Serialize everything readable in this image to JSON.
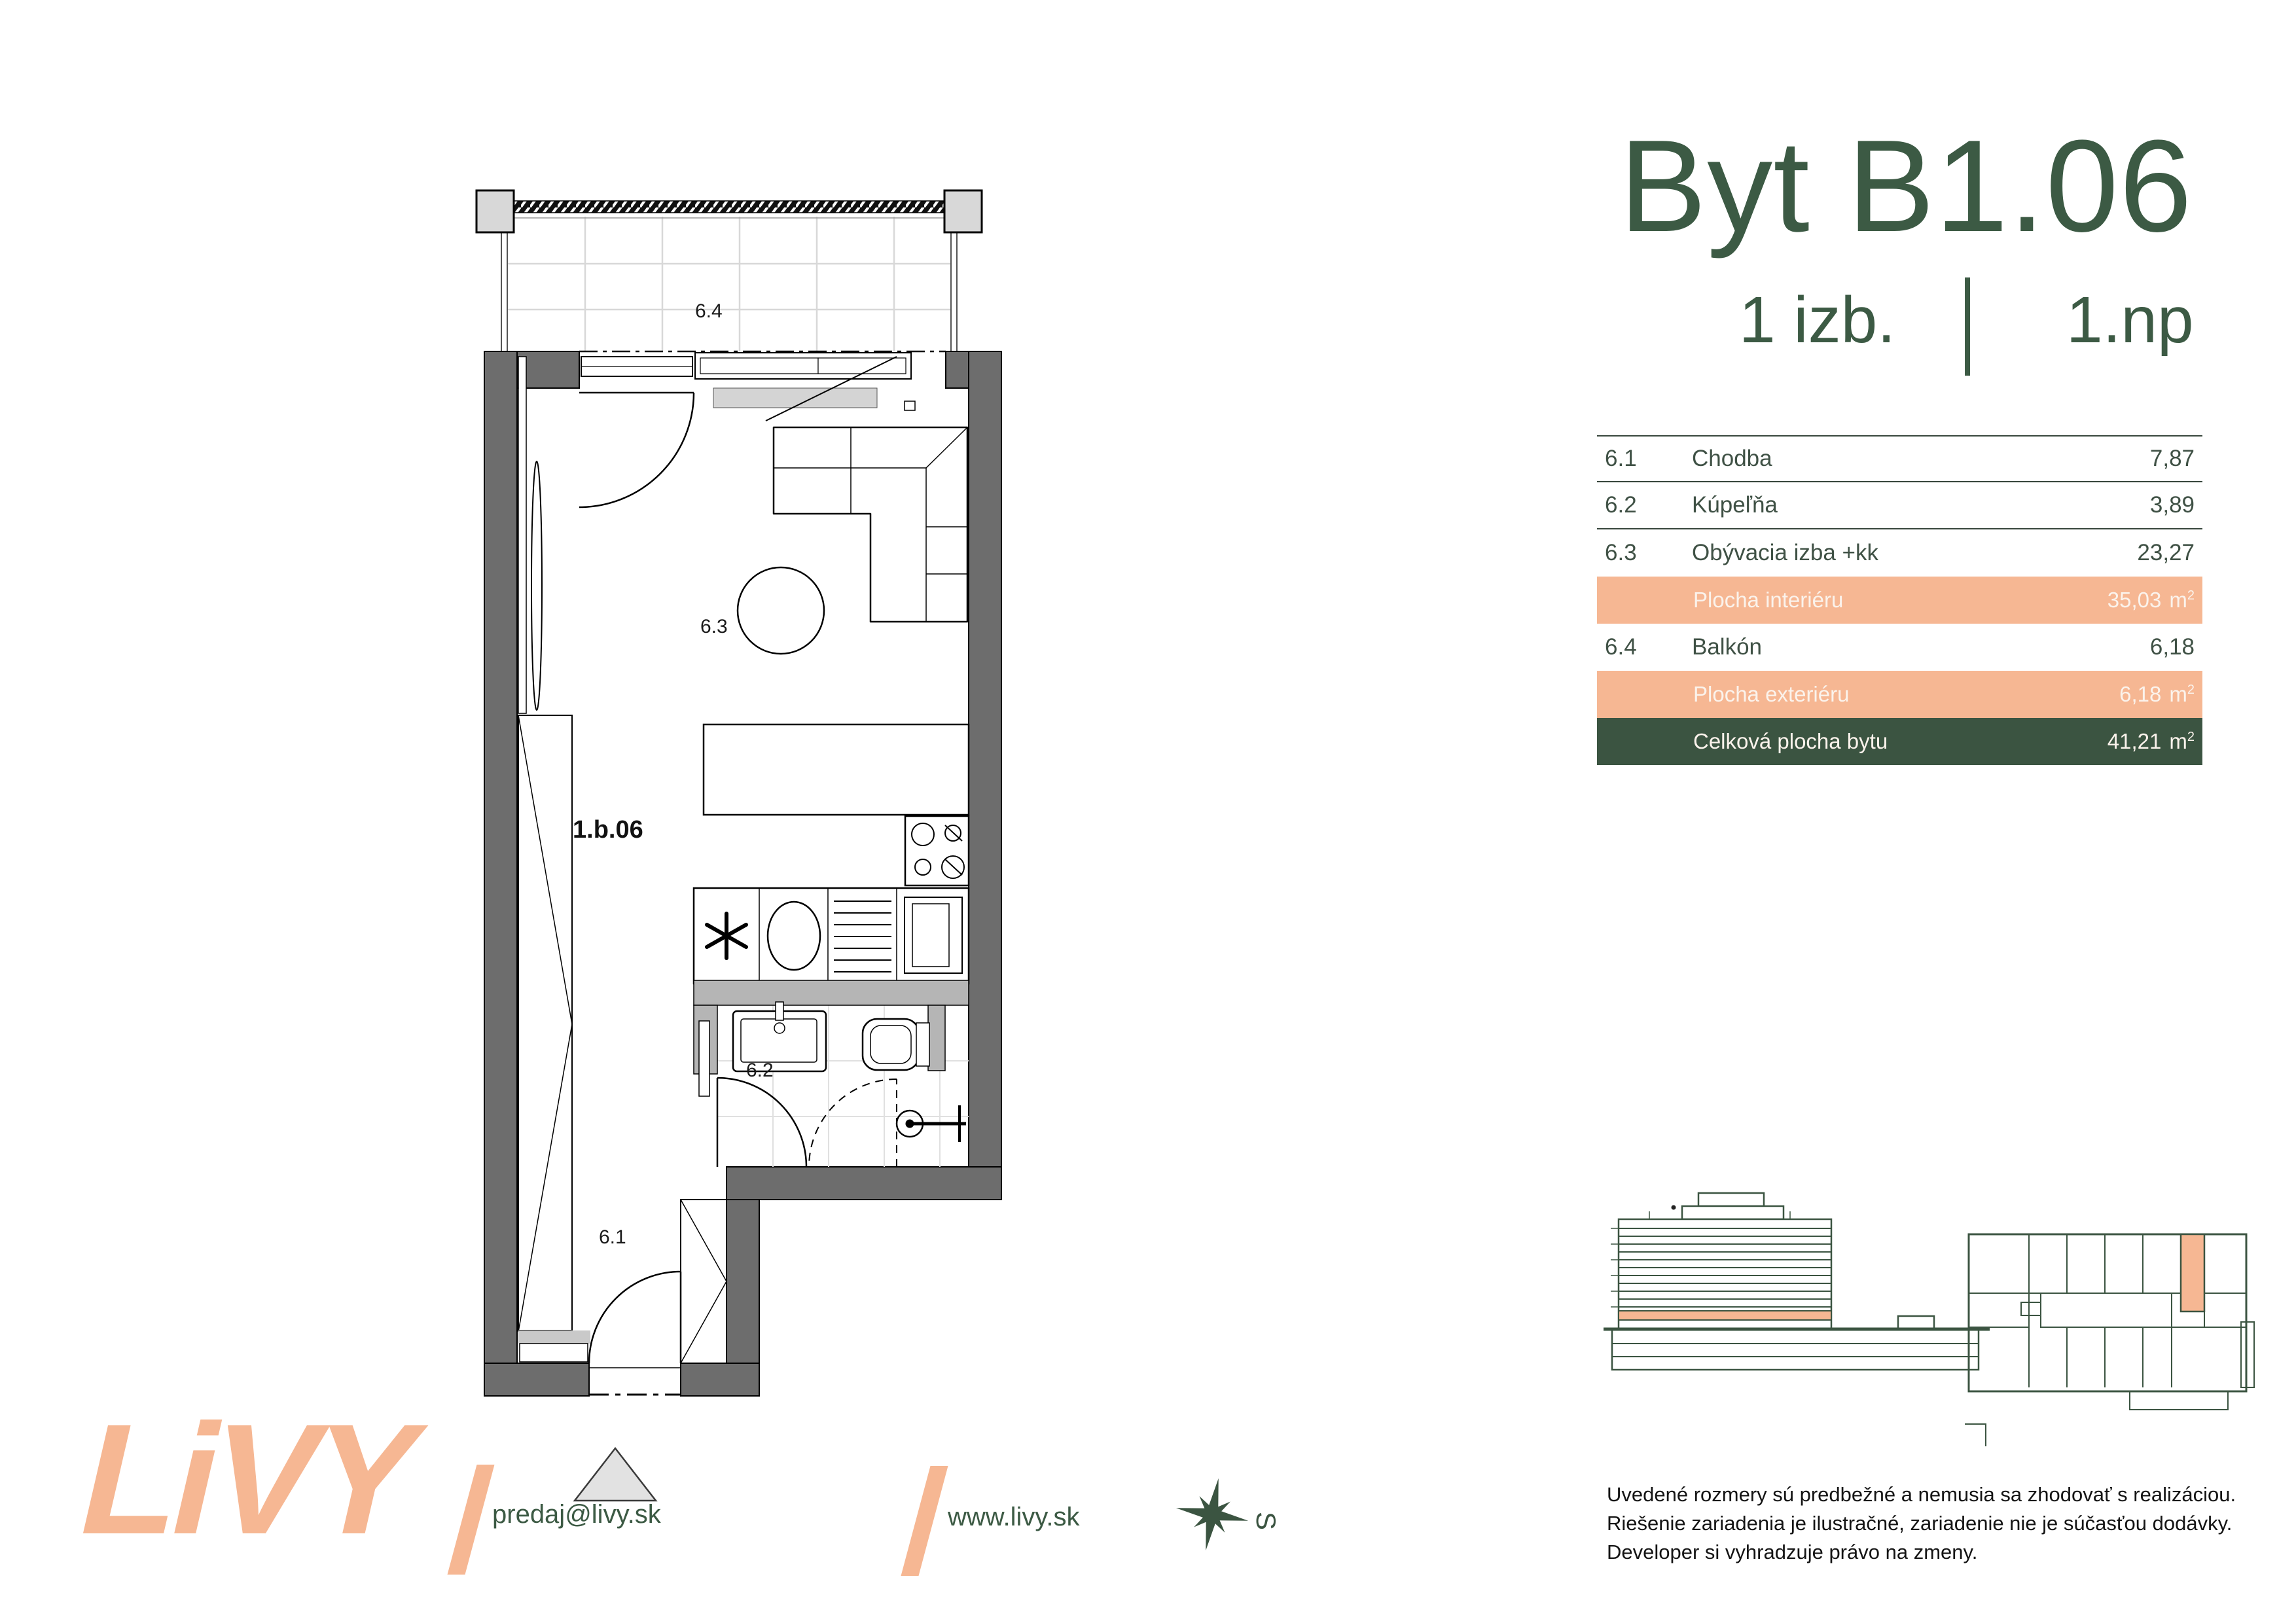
{
  "header": {
    "title": "Byt B1.06",
    "rooms": "1 izb.",
    "floor": "1.np"
  },
  "colors": {
    "green": "#3C5A44",
    "green_band": "#3B5441",
    "peach": "#F6B793",
    "wall_gray": "#6D6D6D",
    "light_gray": "#D8D8D8"
  },
  "table": {
    "rows": [
      {
        "num": "6.1",
        "name": "Chodba",
        "value": "7,87"
      },
      {
        "num": "6.2",
        "name": "Kúpeľňa",
        "value": "3,89"
      },
      {
        "num": "6.3",
        "name": "Obývacia izba +kk",
        "value": "23,27"
      },
      {
        "num": "6.4",
        "name": "Balkón",
        "value": "6,18"
      }
    ],
    "bands": [
      {
        "label": "Plocha interiéru",
        "value": "35,03",
        "unit_base": "m",
        "unit_exp": "2"
      },
      {
        "label": "Plocha exteriéru",
        "value": "6,18",
        "unit_base": "m",
        "unit_exp": "2"
      },
      {
        "label": "Celková plocha bytu",
        "value": "41,21",
        "unit_base": "m",
        "unit_exp": "2"
      }
    ]
  },
  "plan": {
    "labels": {
      "balcony": "6.4",
      "living": "6.3",
      "unit": "1.b.06",
      "bath": "6.2",
      "hall": "6.1"
    }
  },
  "footer": {
    "logo": "LiVY",
    "email": "predaj@livy.sk",
    "web": "www.livy.sk",
    "compass": "S"
  },
  "disclaimer": {
    "lines": [
      "Uvedené rozmery sú predbežné a nemusia sa zhodovať s realizáciou.",
      "Riešenie zariadenia je ilustračné, zariadenie nie je súčasťou dodávky.",
      "Developer si vyhradzuje právo na zmeny."
    ]
  }
}
